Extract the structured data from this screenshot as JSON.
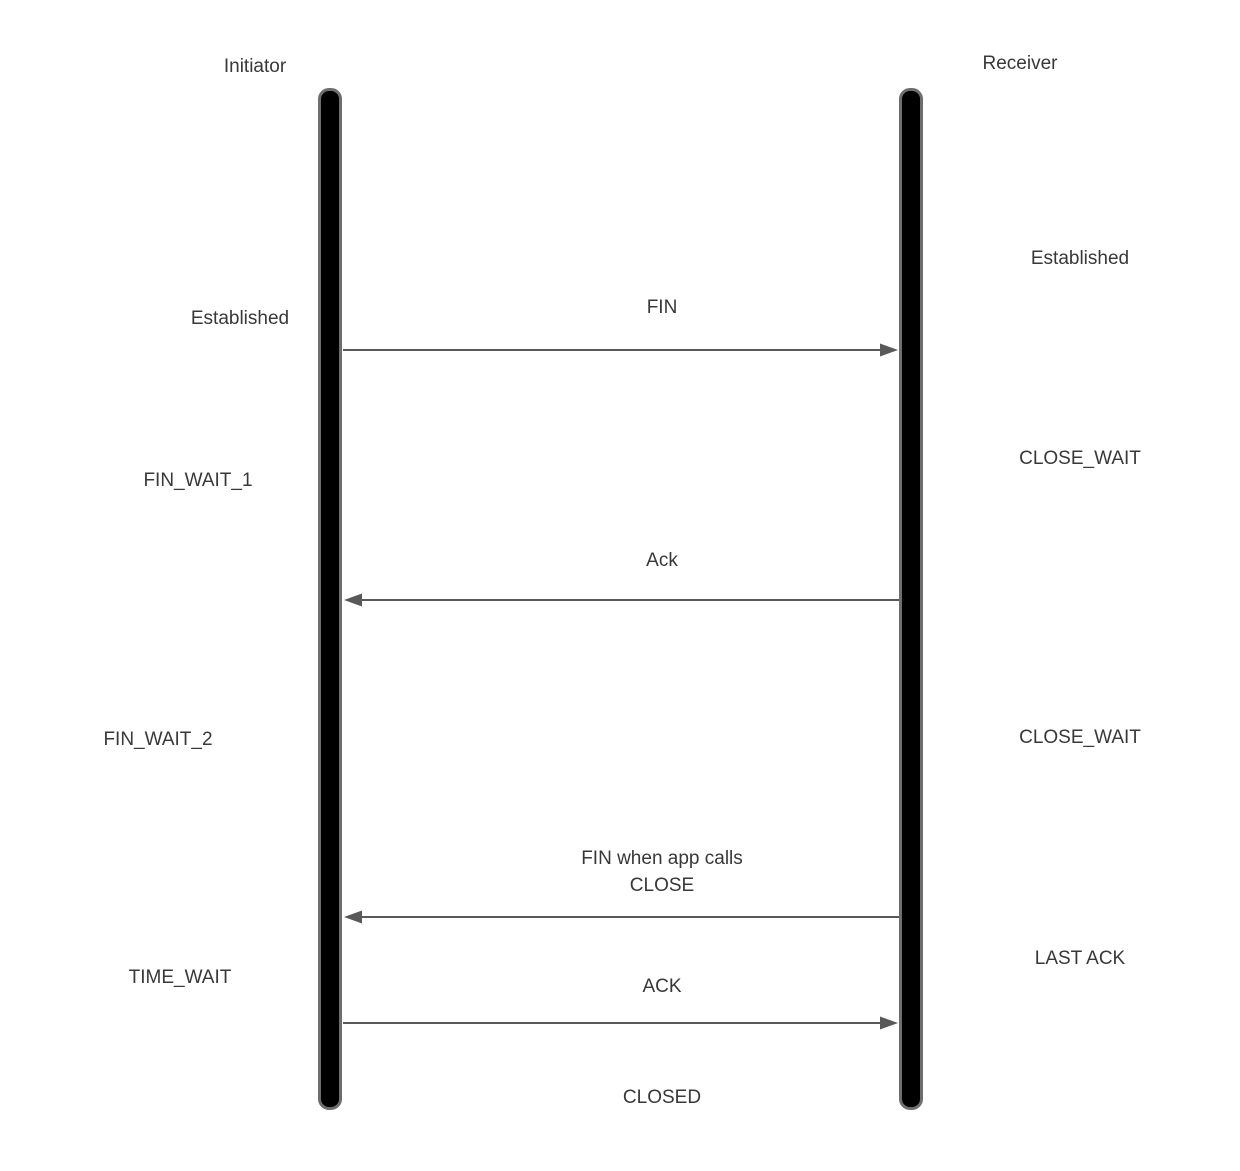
{
  "diagram": {
    "kind": "tcp-connection-termination-sequence",
    "lifelines": [
      {
        "id": "initiator",
        "label": "Initiator"
      },
      {
        "id": "receiver",
        "label": "Receiver"
      }
    ],
    "initiator_states": [
      {
        "label": "Established"
      },
      {
        "label": "FIN_WAIT_1"
      },
      {
        "label": "FIN_WAIT_2"
      },
      {
        "label": "TIME_WAIT"
      }
    ],
    "receiver_states": [
      {
        "label": "Established"
      },
      {
        "label": "CLOSE_WAIT"
      },
      {
        "label": "CLOSE_WAIT"
      },
      {
        "label": "LAST ACK"
      }
    ],
    "messages": [
      {
        "label": "FIN",
        "from": "initiator",
        "to": "receiver",
        "direction": "right"
      },
      {
        "label": "Ack",
        "from": "receiver",
        "to": "initiator",
        "direction": "left"
      },
      {
        "label": "FIN when app calls",
        "label_line2": "CLOSE",
        "from": "receiver",
        "to": "initiator",
        "direction": "left"
      },
      {
        "label": "ACK",
        "from": "initiator",
        "to": "receiver",
        "direction": "right"
      }
    ],
    "final_state": "CLOSED",
    "colors": {
      "background": "#ffffff",
      "text": "#383838",
      "arrow_line": "#595959",
      "lifeline_fill": "#000000",
      "lifeline_border": "#6e6e6e"
    }
  }
}
